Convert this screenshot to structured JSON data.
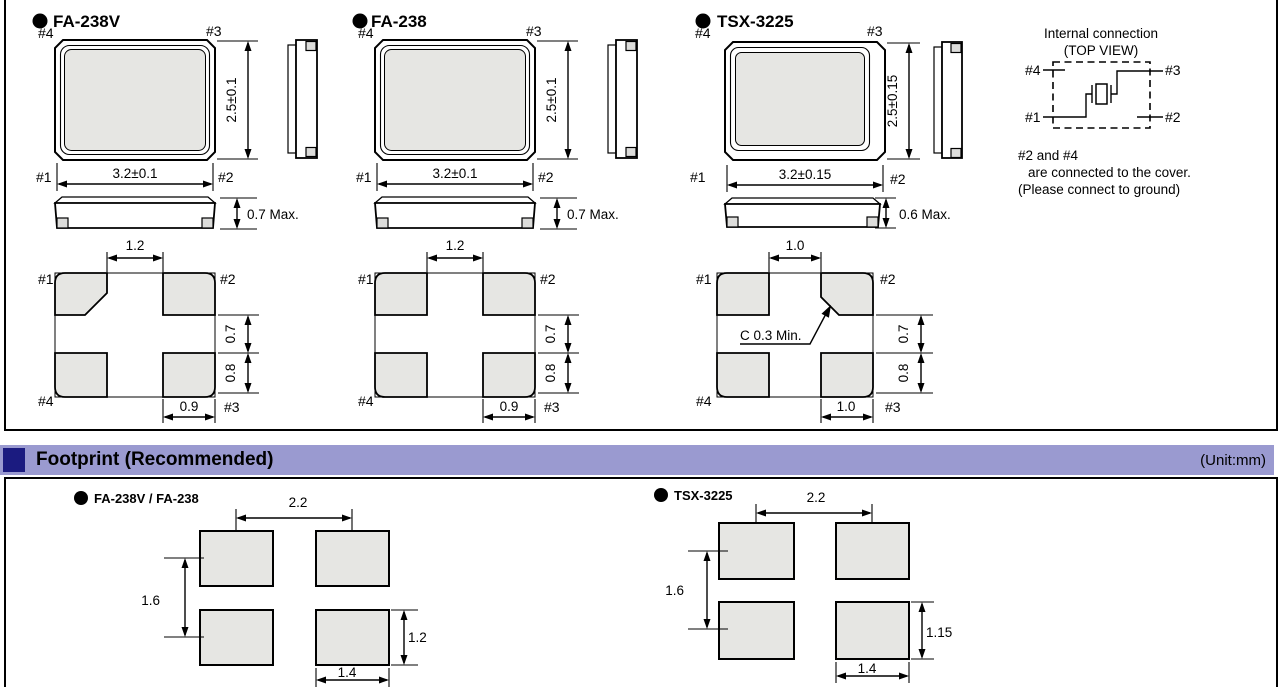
{
  "section": {
    "header": "Footprint (Recommended)",
    "unit": "(Unit:mm)"
  },
  "packages": [
    {
      "name": "FA-238V",
      "pins": {
        "p1": "#1",
        "p2": "#2",
        "p3": "#3",
        "p4": "#4"
      },
      "dims": {
        "body_width": "3.2±0.1",
        "body_height": "2.5±0.1",
        "thickness": "0.7 Max.",
        "pad_gap": "1.2",
        "pad_offset": "0.7",
        "pad_height": "0.8",
        "pad_width": "0.9"
      }
    },
    {
      "name": "FA-238",
      "pins": {
        "p1": "#1",
        "p2": "#2",
        "p3": "#3",
        "p4": "#4"
      },
      "dims": {
        "body_width": "3.2±0.1",
        "body_height": "2.5±0.1",
        "thickness": "0.7 Max.",
        "pad_gap": "1.2",
        "pad_offset": "0.7",
        "pad_height": "0.8",
        "pad_width": "0.9"
      }
    },
    {
      "name": "TSX-3225",
      "pins": {
        "p1": "#1",
        "p2": "#2",
        "p3": "#3",
        "p4": "#4"
      },
      "dims": {
        "body_width": "3.2±0.15",
        "body_height": "2.5±0.15",
        "thickness": "0.6 Max.",
        "pad_gap": "1.0",
        "pad_offset": "0.7",
        "pad_height": "0.8",
        "pad_width": "1.0",
        "chamfer_note": "C 0.3 Min."
      }
    }
  ],
  "internal_connection": {
    "title": "Internal connection",
    "subtitle": "(TOP VIEW)",
    "pins": {
      "p1": "#1",
      "p2": "#2",
      "p3": "#3",
      "p4": "#4"
    },
    "notes": [
      "#2 and #4",
      "are connected to the cover.",
      "(Please connect to ground)"
    ]
  },
  "footprints": [
    {
      "name": "FA-238V / FA-238",
      "dims": {
        "pitch_x": "2.2",
        "pitch_y": "1.6",
        "pad_height": "1.2",
        "pad_width": "1.4"
      }
    },
    {
      "name": "TSX-3225",
      "dims": {
        "pitch_x": "2.2",
        "pitch_y": "1.6",
        "pad_height": "1.15",
        "pad_width": "1.4"
      }
    }
  ],
  "colors": {
    "band_background": "#9a9ad0",
    "band_square": "#1b1b80",
    "pad_fill": "#e6e6e3"
  }
}
